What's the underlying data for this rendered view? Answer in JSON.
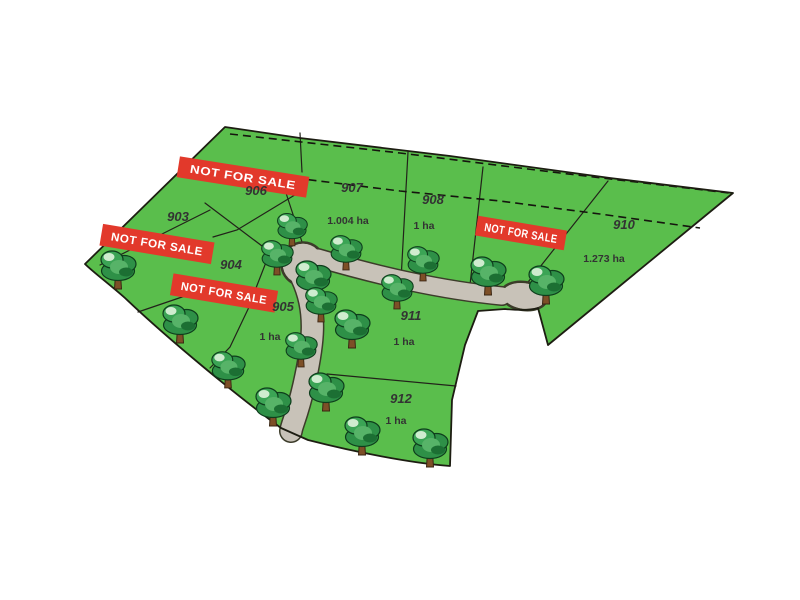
{
  "map": {
    "title": "Residential lot subdivision site plan",
    "banner_label": "NOT FOR SALE",
    "colors": {
      "background": "#ffffff",
      "land": "#5abe4c",
      "land_outline": "#1d1d12",
      "road": "#c8c2b8",
      "road_outline": "#3c3c2a",
      "banner": "#e2392b",
      "banner_text": "#ffffff",
      "label": "#333333",
      "tree_dark": "#1c6f33",
      "tree_mid": "#2e9047",
      "tree_light": "#cfeccf",
      "trunk": "#7d4f27"
    },
    "lots": [
      {
        "number": "903",
        "area": "",
        "x": 178,
        "y": 221
      },
      {
        "number": "904",
        "area": "",
        "x": 231,
        "y": 269
      },
      {
        "number": "905",
        "area": "1 ha",
        "x": 283,
        "y": 311,
        "area_x": 270,
        "area_y": 340
      },
      {
        "number": "906",
        "area": "",
        "x": 256,
        "y": 195
      },
      {
        "number": "907",
        "area": "1.004 ha",
        "x": 352,
        "y": 192,
        "area_x": 348,
        "area_y": 224
      },
      {
        "number": "908",
        "area": "1 ha",
        "x": 433,
        "y": 204,
        "area_x": 424,
        "area_y": 229
      },
      {
        "number": "910",
        "area": "1.273 ha",
        "x": 624,
        "y": 229,
        "area_x": 604,
        "area_y": 262
      },
      {
        "number": "911",
        "area": "1 ha",
        "x": 411,
        "y": 320,
        "area_x": 404,
        "area_y": 345
      },
      {
        "number": "912",
        "area": "1 ha",
        "x": 401,
        "y": 403,
        "area_x": 396,
        "area_y": 424
      }
    ],
    "banners": [
      {
        "x": 243,
        "y": 177,
        "w": 131,
        "h": 21,
        "angle": 9
      },
      {
        "x": 157,
        "y": 244,
        "w": 113,
        "h": 22,
        "angle": 9.5
      },
      {
        "x": 224,
        "y": 293,
        "w": 106,
        "h": 22,
        "angle": 9.5
      },
      {
        "x": 521,
        "y": 233,
        "w": 90,
        "h": 20,
        "angle": 9.5
      }
    ],
    "trees": [
      {
        "x": 118,
        "y": 268,
        "s": 1
      },
      {
        "x": 180,
        "y": 322,
        "s": 1
      },
      {
        "x": 228,
        "y": 368,
        "s": 0.95
      },
      {
        "x": 277,
        "y": 256,
        "s": 0.9
      },
      {
        "x": 292,
        "y": 228,
        "s": 0.85
      },
      {
        "x": 313,
        "y": 278,
        "s": 1
      },
      {
        "x": 321,
        "y": 303,
        "s": 0.9
      },
      {
        "x": 346,
        "y": 251,
        "s": 0.9
      },
      {
        "x": 352,
        "y": 327,
        "s": 1
      },
      {
        "x": 301,
        "y": 348,
        "s": 0.9
      },
      {
        "x": 273,
        "y": 405,
        "s": 1
      },
      {
        "x": 326,
        "y": 390,
        "s": 1
      },
      {
        "x": 362,
        "y": 434,
        "s": 1
      },
      {
        "x": 430,
        "y": 446,
        "s": 1
      },
      {
        "x": 397,
        "y": 290,
        "s": 0.9
      },
      {
        "x": 423,
        "y": 262,
        "s": 0.9
      },
      {
        "x": 488,
        "y": 274,
        "s": 1
      },
      {
        "x": 546,
        "y": 283,
        "s": 1
      }
    ]
  }
}
